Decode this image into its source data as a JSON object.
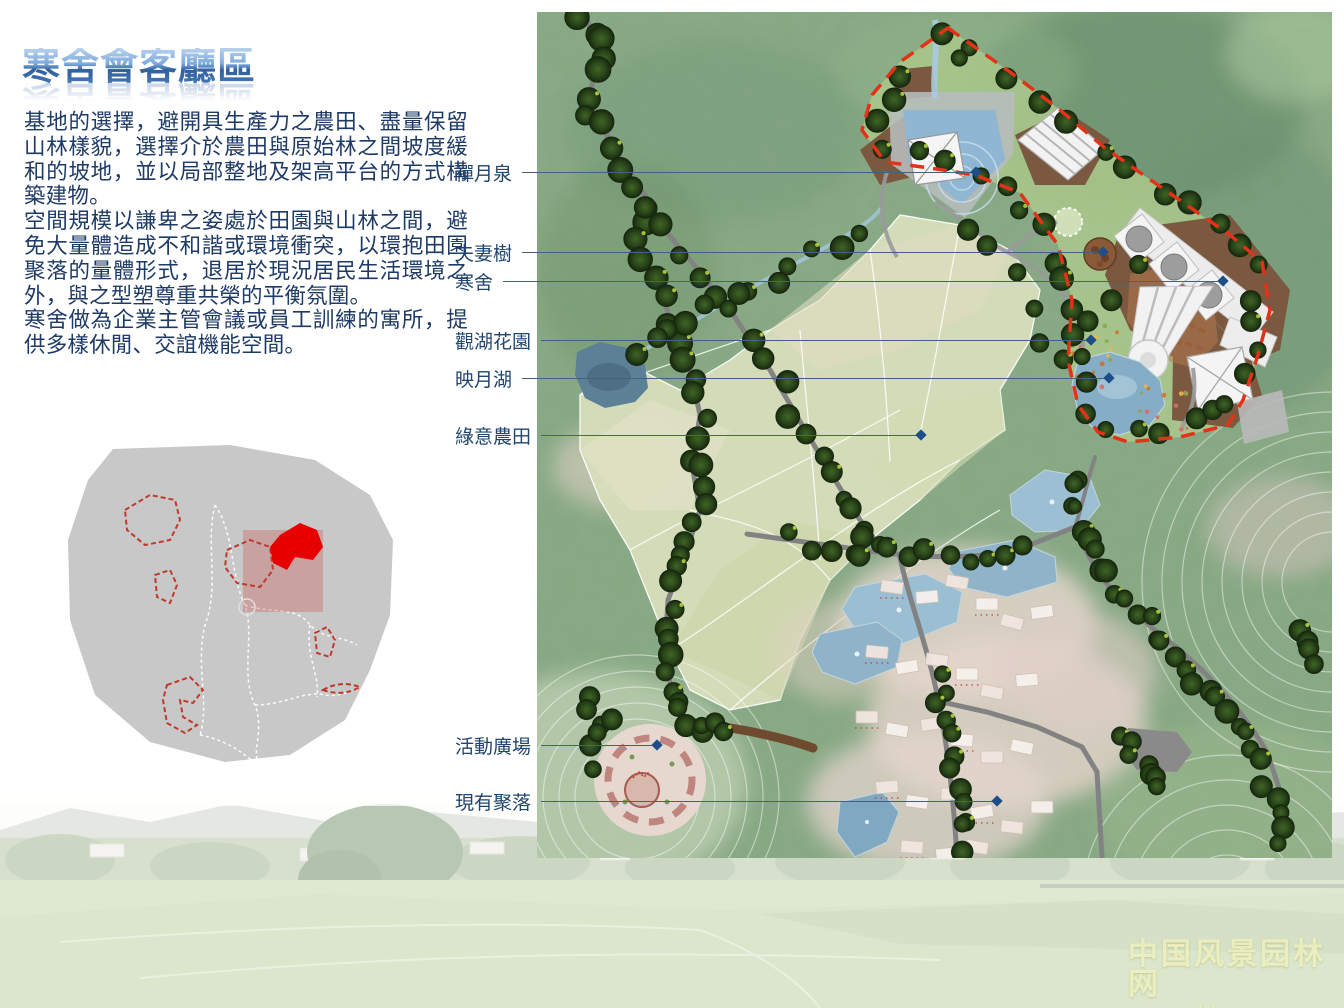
{
  "header": {
    "title": "寒舍會客廳區"
  },
  "intro": {
    "p1": "基地的選擇，避開具生產力之農田、盡量保留山林樣貌，選擇介於農田與原始林之間坡度緩和的坡地，並以局部整地及架高平台的方式構築建物。",
    "p2": "空間規模以謙卑之姿處於田園與山林之間，避免大量體造成不和諧或環境衝突，以環抱田園聚落的量體形式，退居於現況居民生活環境之外，與之型塑尊重共榮的平衡氛圍。",
    "p3": "寒舍做為企業主管會議或員工訓練的寓所，提供多樣休閒、交誼機能空間。"
  },
  "plan_labels": [
    {
      "text": "禪月泉"
    },
    {
      "text": "夫妻樹"
    },
    {
      "text": "寒舍"
    },
    {
      "text": "觀湖花園"
    },
    {
      "text": "映月湖"
    },
    {
      "text": "綠意農田"
    },
    {
      "text": "活動廣場"
    },
    {
      "text": "現有聚落"
    }
  ],
  "watermark": {
    "site_name": "中国风景园林网",
    "site_url": "chla.com.cn"
  },
  "colors": {
    "title_blue": "#2f5f9e",
    "text_navy": "#1e3a66",
    "leader_line": "#44627e",
    "diamond_marker": "#1d4e89",
    "site_boundary_red": "#e23318",
    "locator_highlight_red": "#e60000",
    "forest_green": "#83a67f",
    "pond_blue": "#8fb6d2"
  }
}
